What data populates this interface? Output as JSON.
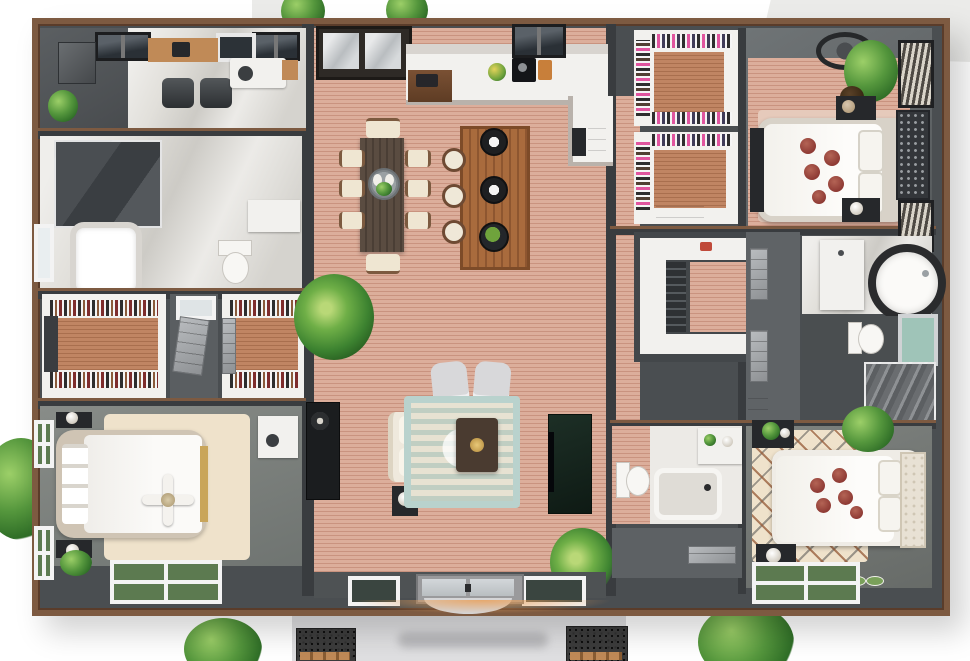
{
  "scene": {
    "kind": "3d-floor-plan-top-down-rendering",
    "house": {
      "rooms": [
        {
          "name": "office-study",
          "floor": "marble",
          "furniture": [
            "skylight-windows",
            "wood-credenza",
            "office-chairs",
            "storage-cabinet",
            "plant",
            "reading-desk"
          ]
        },
        {
          "name": "bathroom-left",
          "floor": "marble",
          "furniture": [
            "walk-in-shower",
            "bathtub",
            "toilet",
            "vanity",
            "window"
          ]
        },
        {
          "name": "walk-in-closet-left-a",
          "floor": "wood",
          "furniture": [
            "clothes-racks"
          ]
        },
        {
          "name": "closet-vestibule",
          "furniture": [
            "open-door"
          ]
        },
        {
          "name": "walk-in-closet-left-b",
          "floor": "wood",
          "furniture": [
            "clothes-racks"
          ]
        },
        {
          "name": "bedroom-left",
          "floor": "carpet",
          "furniture": [
            "double-bed",
            "ceiling-fan",
            "nightstands",
            "foot-bench",
            "area-rug",
            "vanity-desk",
            "garden-windows",
            "plant"
          ]
        },
        {
          "name": "great-room",
          "floor": "wood",
          "zones": [
            "kitchen",
            "dining",
            "living",
            "entry-foyer"
          ],
          "furniture": [
            "kitchen-counter",
            "range",
            "sink-cabinet",
            "island",
            "pendant-lights",
            "bar-stools",
            "dining-table",
            "dining-chairs",
            "palm-plant",
            "sofa",
            "armchairs",
            "area-rug",
            "coffee-table",
            "media-console",
            "tv-wall-unit",
            "entry-double-door"
          ]
        },
        {
          "name": "pantry-closet-a",
          "furniture": [
            "shelving",
            "clothes"
          ]
        },
        {
          "name": "pantry-closet-b",
          "furniture": [
            "shelving",
            "dresser"
          ]
        },
        {
          "name": "master-walk-in-closet",
          "floor": "wood",
          "furniture": [
            "u-shaped-counter",
            "drawer-stacks"
          ]
        },
        {
          "name": "bedroom-top-right",
          "floor": "wood",
          "furniture": [
            "double-bed",
            "tufted-headboard",
            "ceiling-fan",
            "plant",
            "nightstands",
            "area-rug",
            "blind-windows",
            "foot-bench"
          ]
        },
        {
          "name": "bathroom-right",
          "floor": "marble",
          "furniture": [
            "vanity",
            "round-tub",
            "toilet",
            "window",
            "marble-shower"
          ]
        },
        {
          "name": "bathroom-bottom-center",
          "furniture": [
            "toilet",
            "bathtub",
            "vanity"
          ]
        },
        {
          "name": "hall-bottom-center",
          "furniture": [
            "door"
          ]
        },
        {
          "name": "bedroom-bottom-right",
          "floor": "carpet",
          "furniture": [
            "double-bed",
            "diamond-rug",
            "nightstands",
            "plants",
            "garden-windows"
          ]
        }
      ],
      "exterior": [
        "front-porch-slab",
        "walkway-planters",
        "shrub",
        "trees",
        "roof-ferns"
      ]
    }
  },
  "palette": {
    "bg": "#ffffff",
    "bgblock": "#ebebe9",
    "porch": "#dfdfe1",
    "wall": "#4a4e51",
    "walldark": "#393c3f",
    "trim": "#7d5a41",
    "trimdark": "#5a3c2a",
    "wood": "#dcae9b",
    "woodd": "#c9937f",
    "woodc": "#c08563",
    "woodcd": "#a96f4e",
    "marble": "#e2e0db",
    "whitef": "#f2f1ee",
    "cream": "#efe2cb",
    "teal": "#b9d2cd",
    "darkf": "#26282b",
    "charcoal": "#3a3d40",
    "brownf": "#7a5134",
    "blonde": "#c08a57",
    "island": "#a96b3d",
    "tablewood": "#5a4c41",
    "green": "#55973d",
    "greend": "#2f6e27",
    "rose": "#8e3a34",
    "glow": "#e9a05a",
    "tealglass": "#9fc4b8",
    "pink": "#e0559f"
  }
}
